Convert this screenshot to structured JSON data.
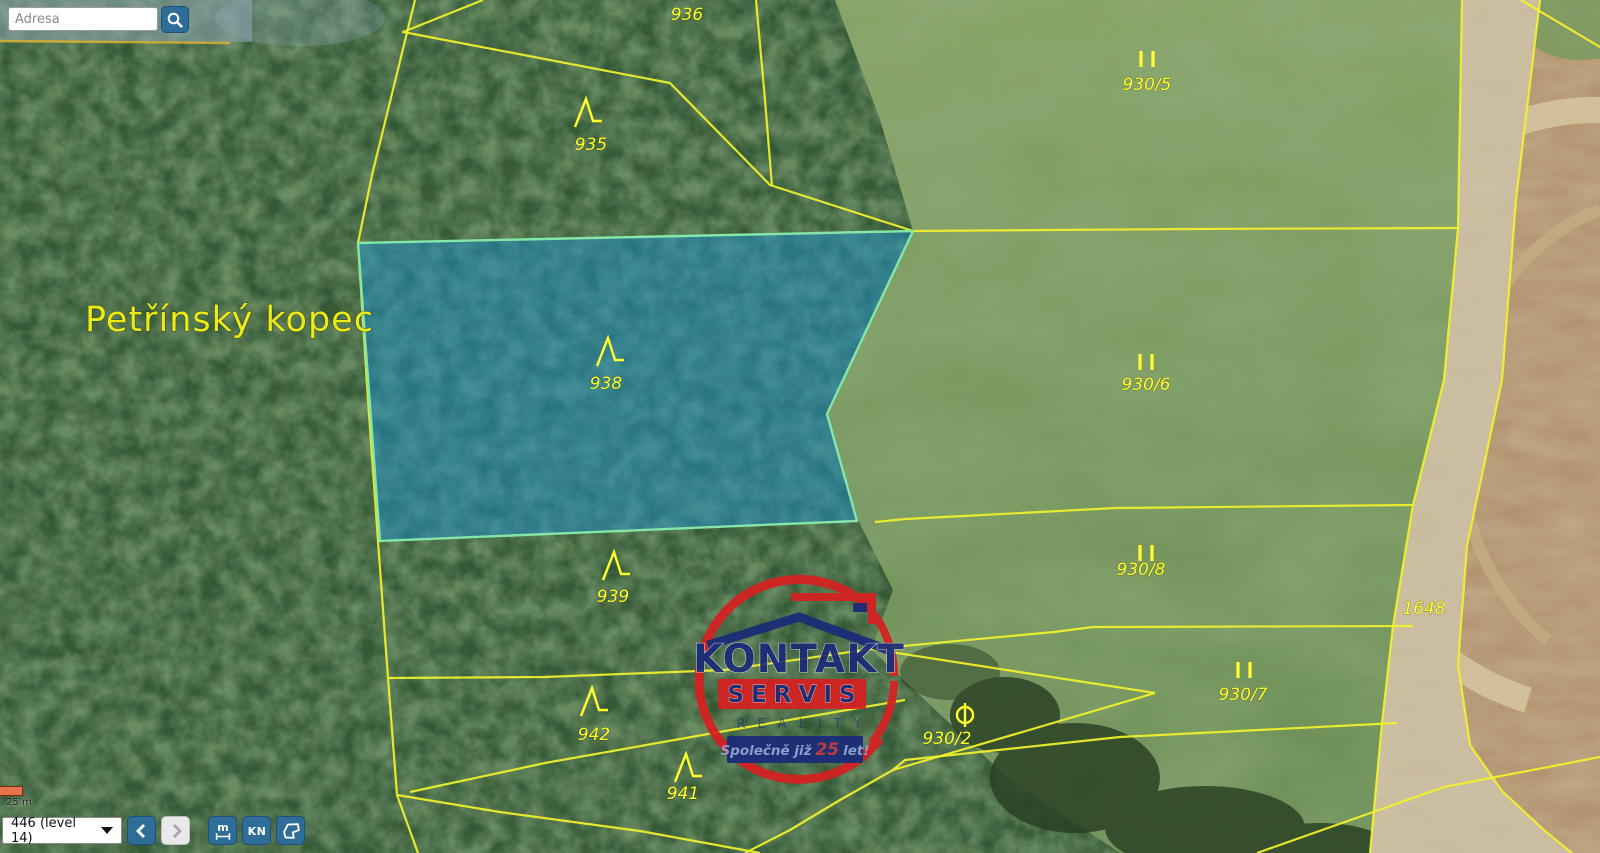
{
  "search": {
    "placeholder": "Adresa"
  },
  "map": {
    "place_label": "Petřínský kopec",
    "highlighted_parcel": "938",
    "parcels": [
      {
        "number": "936",
        "x": 687,
        "y": 20,
        "symbol": "none",
        "sx": 0,
        "sy": 0
      },
      {
        "number": "935",
        "x": 591,
        "y": 150,
        "symbol": "forest",
        "sx": 586,
        "sy": 113
      },
      {
        "number": "938",
        "x": 606,
        "y": 389,
        "symbol": "forest",
        "sx": 608,
        "sy": 352
      },
      {
        "number": "939",
        "x": 613,
        "y": 602,
        "symbol": "forest",
        "sx": 614,
        "sy": 566
      },
      {
        "number": "942",
        "x": 594,
        "y": 740,
        "symbol": "forest",
        "sx": 592,
        "sy": 702
      },
      {
        "number": "941",
        "x": 683,
        "y": 799,
        "symbol": "forest",
        "sx": 686,
        "sy": 768
      },
      {
        "number": "930/5",
        "x": 1147,
        "y": 90,
        "symbol": "meadow",
        "sx": 1147,
        "sy": 59
      },
      {
        "number": "930/6",
        "x": 1146,
        "y": 390,
        "symbol": "meadow",
        "sx": 1146,
        "sy": 362
      },
      {
        "number": "930/8",
        "x": 1141,
        "y": 575,
        "symbol": "meadow",
        "sx": 1146,
        "sy": 553
      },
      {
        "number": "930/7",
        "x": 1243,
        "y": 700,
        "symbol": "meadow",
        "sx": 1244,
        "sy": 670
      },
      {
        "number": "930/2",
        "x": 947,
        "y": 744,
        "symbol": "circle",
        "sx": 965,
        "sy": 715
      },
      {
        "number": "1648",
        "x": 1424,
        "y": 614,
        "symbol": "none",
        "sx": 0,
        "sy": 0
      }
    ],
    "watermark": {
      "title": "KONTAKT",
      "subtitle": "SERVIS",
      "reality": "REALITY",
      "tagline_prefix": "Společně již",
      "tagline_num": "25",
      "tagline_suffix": "let!"
    }
  },
  "controls": {
    "scale_label": "25 m",
    "level_select": "446 (level 14)",
    "measure_label": "m",
    "kn_label": "KN"
  },
  "colors": {
    "boundary_yellow": "#f2f22b",
    "highlight_fill": "#1e90c8",
    "highlight_stroke": "#84e6a8",
    "label_yellow": "#ffff2e",
    "button_blue": "#2e6d98",
    "button_border": "#1c4f79",
    "scalebar_orange": "#e8724d",
    "logo_red": "#d62020",
    "logo_navy": "#1b2a78"
  }
}
